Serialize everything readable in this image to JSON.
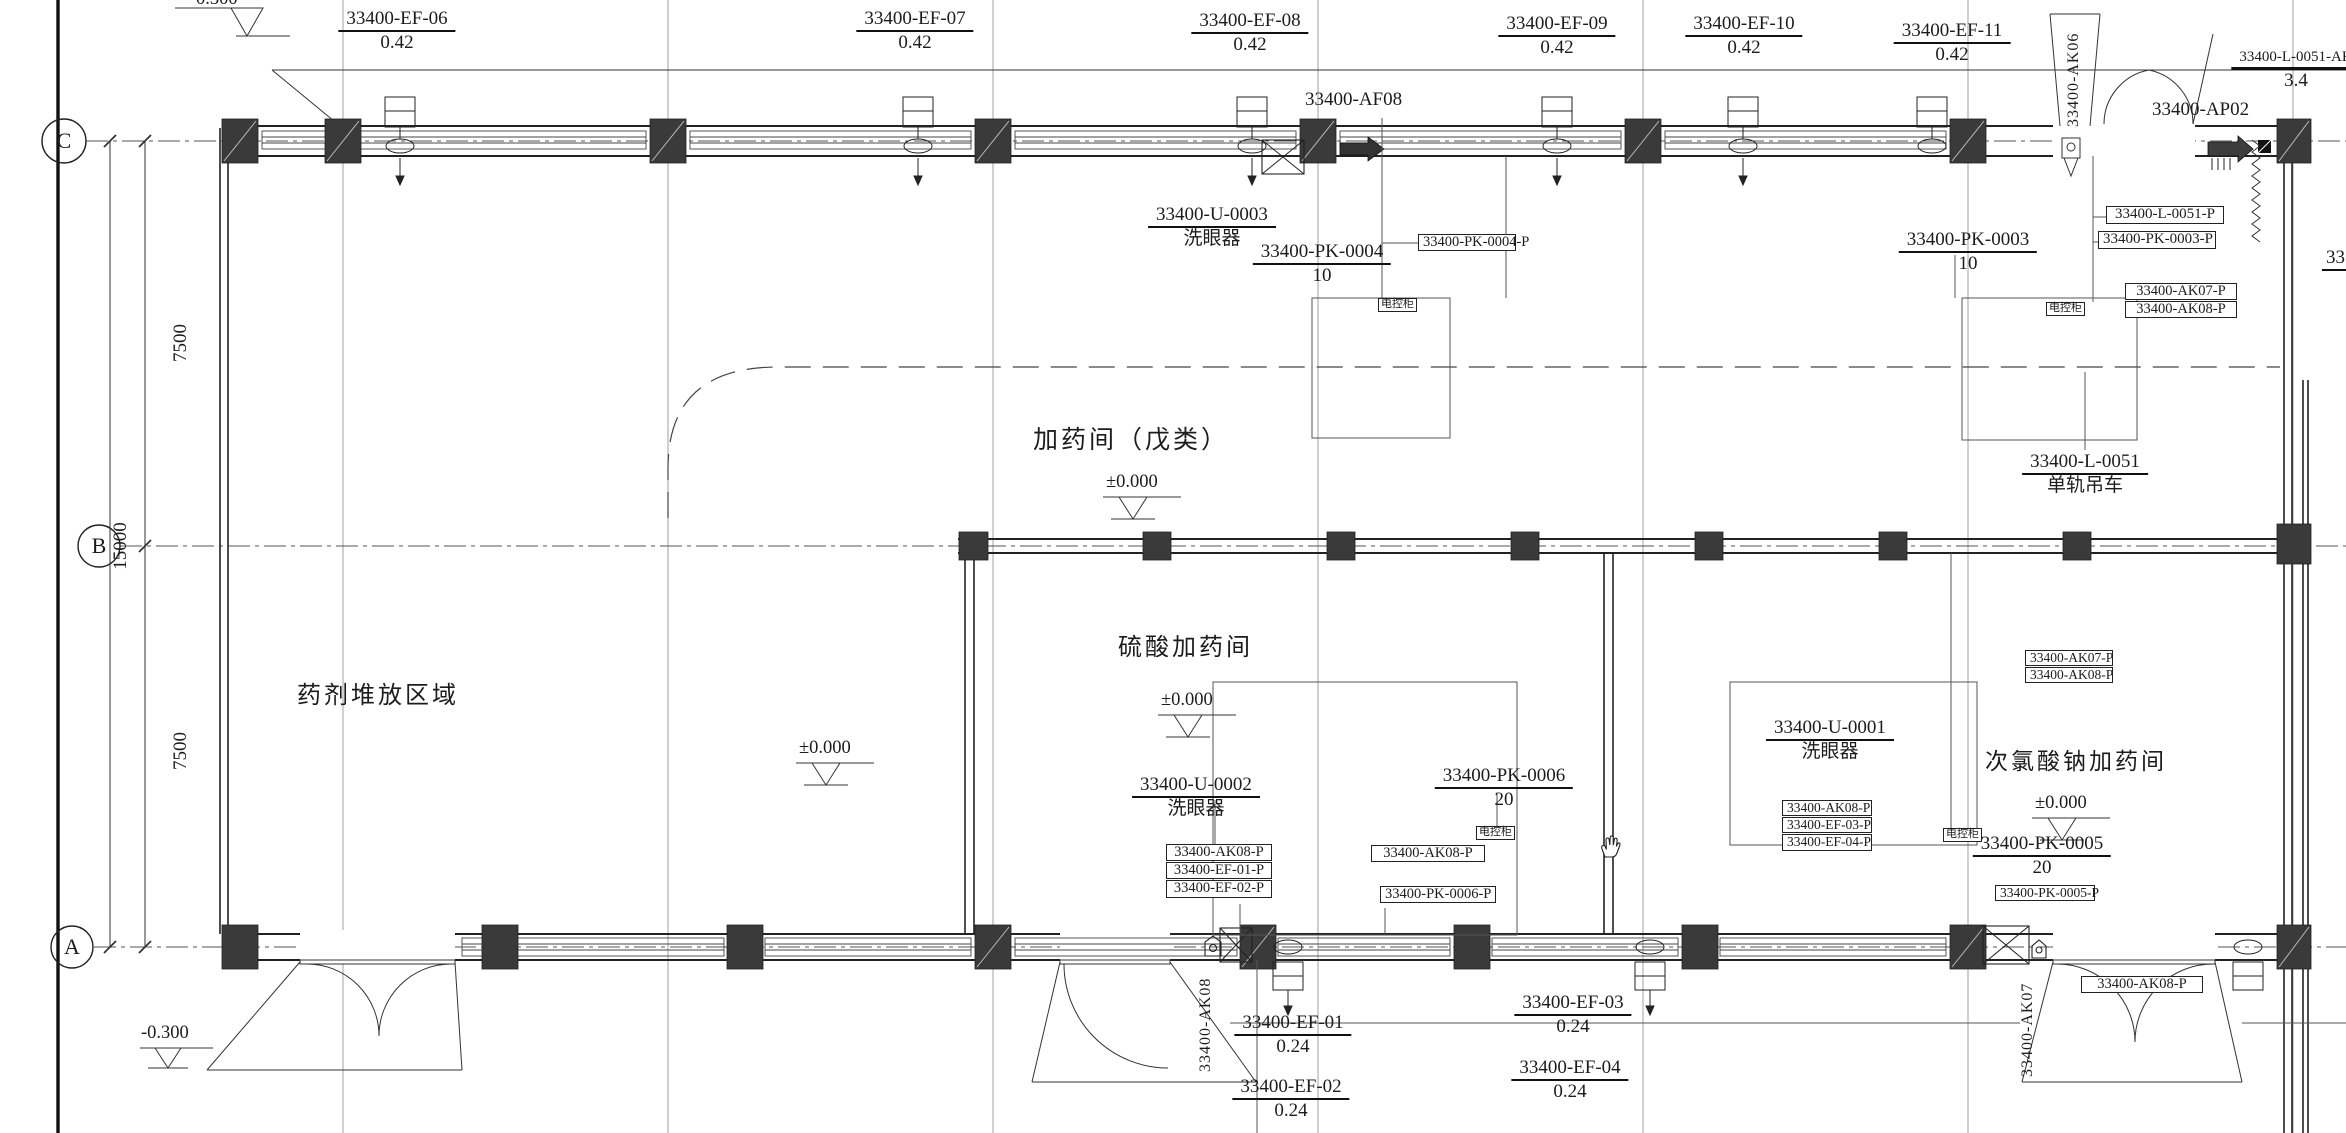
{
  "drawing": {
    "grid": {
      "c": "C",
      "b": "B",
      "a": "A"
    },
    "dims": {
      "upper": "7500",
      "total": "15000",
      "lower": "7500"
    },
    "levels": {
      "pm": "±0.000",
      "m300": "-0.300",
      "top_clipped": "0.300"
    },
    "rooms": {
      "dosing_main": "加药间（戊类）",
      "chemical_storage": "药剂堆放区域",
      "sulfuric": "硫酸加药间",
      "hypochlorite": "次氯酸钠加药间"
    },
    "fans_top": [
      {
        "tag": "33400-EF-06",
        "value": "0.42"
      },
      {
        "tag": "33400-EF-07",
        "value": "0.42"
      },
      {
        "tag": "33400-EF-08",
        "value": "0.42"
      },
      {
        "tag": "33400-EF-09",
        "value": "0.42"
      },
      {
        "tag": "33400-EF-10",
        "value": "0.42"
      },
      {
        "tag": "33400-EF-11",
        "value": "0.42"
      }
    ],
    "fans_bottom": [
      {
        "tag": "33400-EF-01",
        "value": "0.24"
      },
      {
        "tag": "33400-EF-02",
        "value": "0.24"
      },
      {
        "tag": "33400-EF-03",
        "value": "0.24"
      },
      {
        "tag": "33400-EF-04",
        "value": "0.24"
      }
    ],
    "af08": "33400-AF08",
    "ap02": "33400-AP02",
    "ak06": "33400-AK06",
    "ak07": "33400-AK07",
    "ak08": "33400-AK08",
    "l0051ak": {
      "tag": "33400-L-0051-AK",
      "value": "3.4"
    },
    "monorail": {
      "tag": "33400-L-0051",
      "name": "单轨吊车"
    },
    "eyewash": {
      "u0003": {
        "tag": "33400-U-0003",
        "name": "洗眼器"
      },
      "u0002": {
        "tag": "33400-U-0002",
        "name": "洗眼器"
      },
      "u0001": {
        "tag": "33400-U-0001",
        "name": "洗眼器"
      }
    },
    "pumps": {
      "pk0004": {
        "tag": "33400-PK-0004",
        "value": "10"
      },
      "pk0003": {
        "tag": "33400-PK-0003",
        "value": "10"
      },
      "pk0006": {
        "tag": "33400-PK-0006",
        "value": "20"
      },
      "pk0005": {
        "tag": "33400-PK-0005",
        "value": "20"
      }
    },
    "boxed": {
      "pk0004p": "33400-PK-0004-P",
      "l0051p": "33400-L-0051-P",
      "pk0003p": "33400-PK-0003-P",
      "ak07p": "33400-AK07-P",
      "ak08p": "33400-AK08-P",
      "ef01p": "33400-EF-01-P",
      "ef02p": "33400-EF-02-P",
      "ef03p": "33400-EF-03-P",
      "ef04p": "33400-EF-04-P",
      "pk0006p": "33400-PK-0006-P",
      "pk0005p": "33400-PK-0005-P",
      "panel": "电控柜"
    },
    "partial_right": "33"
  }
}
